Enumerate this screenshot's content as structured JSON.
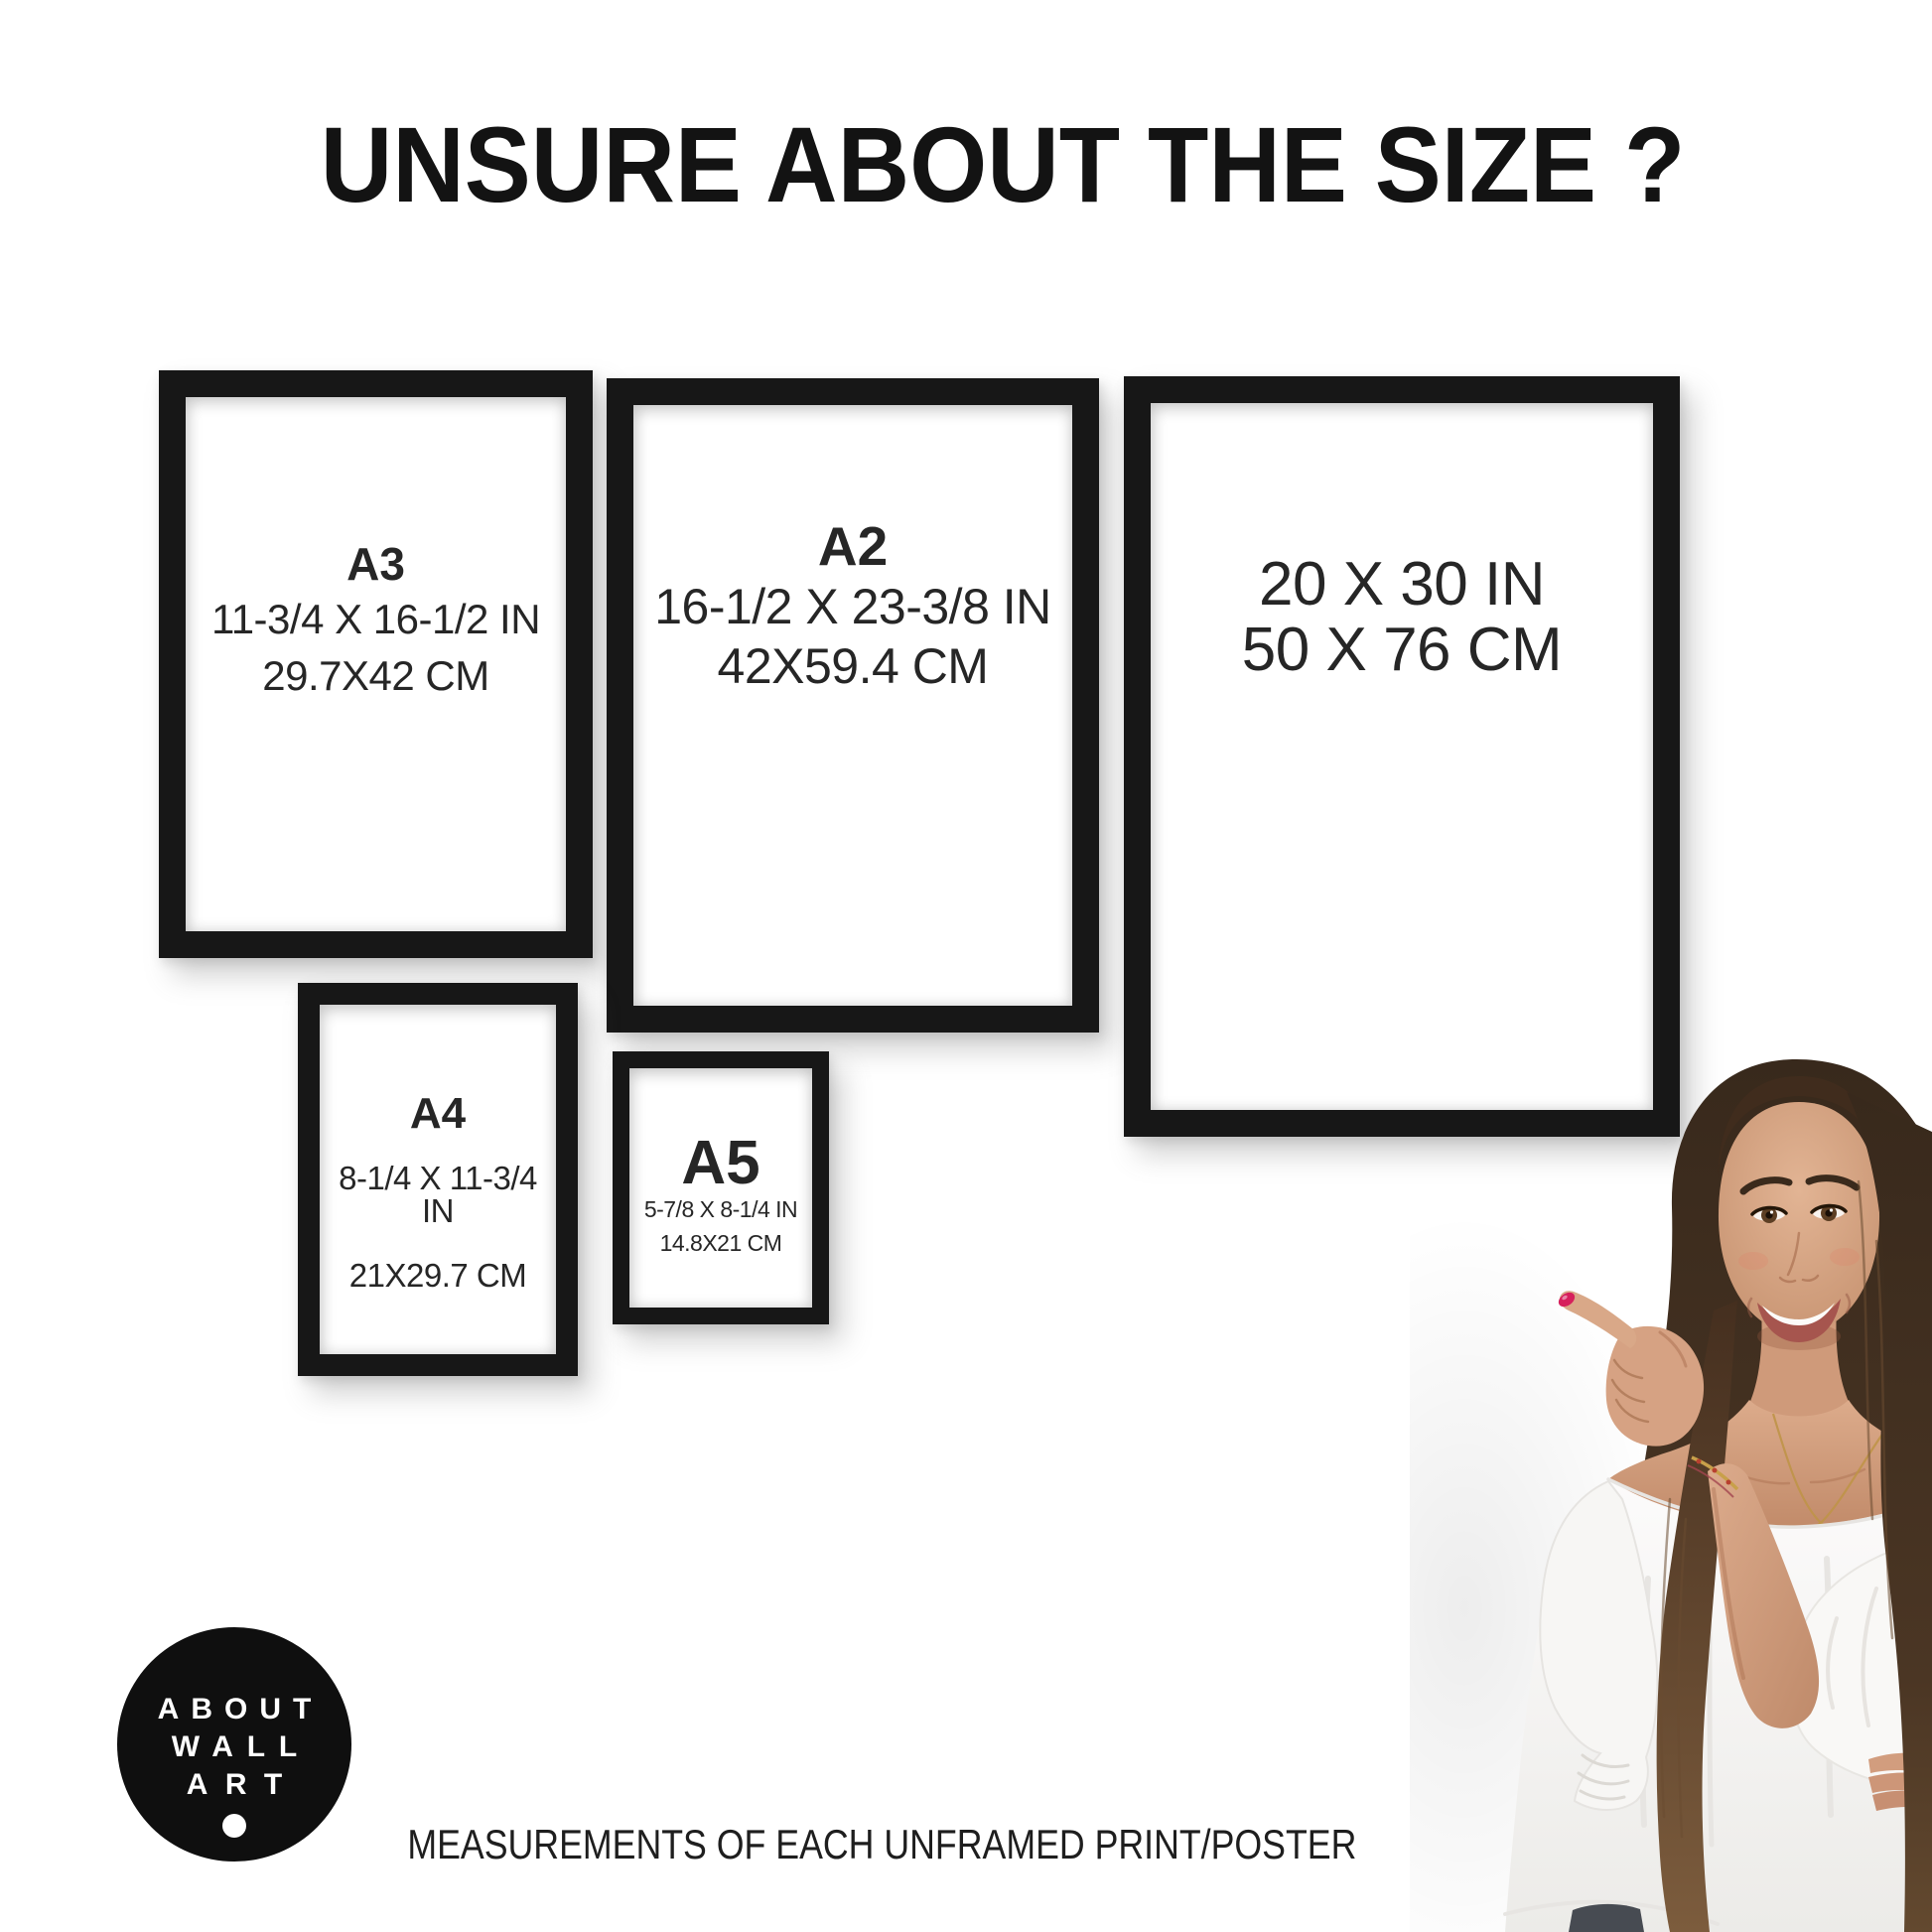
{
  "header": {
    "title": "UNSURE ABOUT THE SIZE ?"
  },
  "frames": [
    {
      "id": "a3",
      "label": "A3",
      "inches": "11-3/4 X 16-1/2 IN",
      "cm": "29.7X42 CM"
    },
    {
      "id": "a2",
      "label": "A2",
      "inches": "16-1/2 X 23-3/8 IN",
      "cm": "42X59.4 CM"
    },
    {
      "id": "20x30",
      "label": "",
      "inches": "20 X 30 IN",
      "cm": "50 X 76 CM"
    },
    {
      "id": "a4",
      "label": "A4",
      "inches": "8-1/4 X 11-3/4 IN",
      "cm": "21X29.7 CM"
    },
    {
      "id": "a5",
      "label": "A5",
      "inches": "5-7/8 X 8-1/4 IN",
      "cm": "14.8X21 CM"
    }
  ],
  "logo": {
    "line1": "ABOUT",
    "line2": "WALL",
    "line3": "ART"
  },
  "footer": {
    "caption": "MEASUREMENTS OF EACH UNFRAMED PRINT/POSTER"
  },
  "colors": {
    "background": "#ffffff",
    "frame": "#171717",
    "text": "#262626",
    "logo_background": "#0f0f0f",
    "logo_text": "#ffffff",
    "nail_polish": "#d6205c",
    "hair": "#4b3626",
    "skin": "#d6a585",
    "blouse": "#fafafa"
  }
}
